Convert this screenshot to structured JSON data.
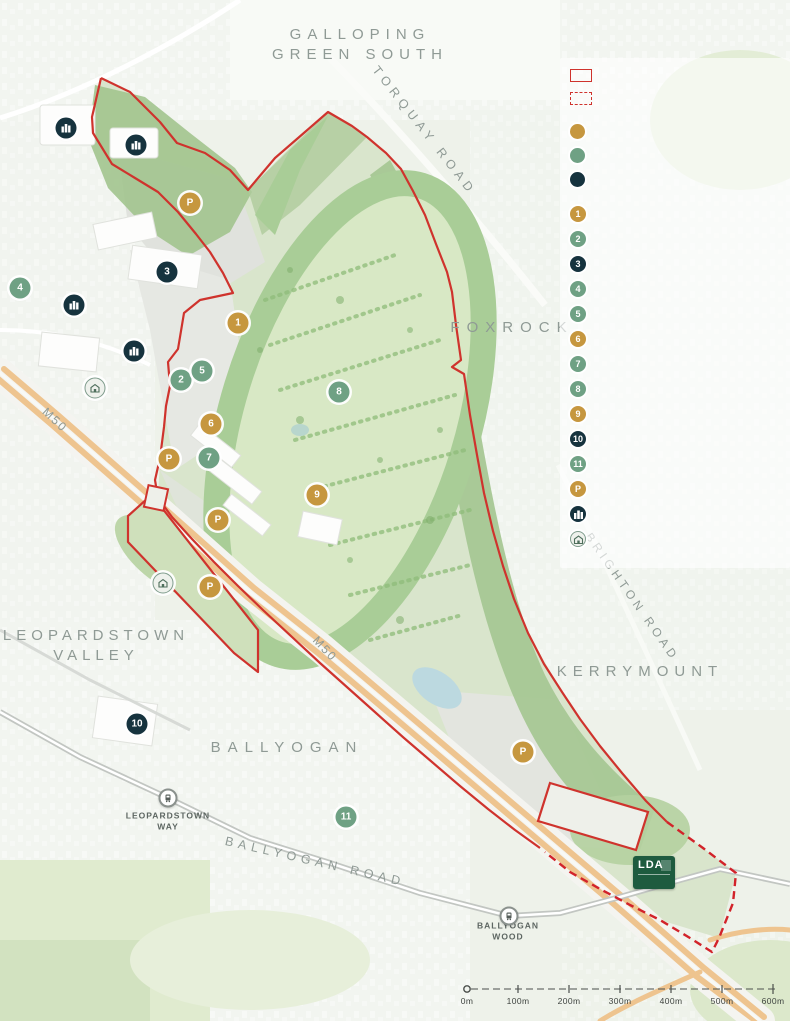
{
  "colors": {
    "boundary_red": "#cf332d",
    "race_gold": "#c6973f",
    "community_green": "#6fa184",
    "business_navy": "#16333e",
    "label_gray": "#8f9a95"
  },
  "legend": {
    "boundaries": [
      {
        "style": "solid",
        "label": "Leopardstown Campus Boundary - HRI"
      },
      {
        "style": "dashed",
        "label": "Leopardstown Campus Boundary - LDA"
      }
    ],
    "categories": [
      {
        "color": "#c6973f",
        "label": "Race Event Uses"
      },
      {
        "color": "#6fa184",
        "label": "Community, Education and Leisure"
      },
      {
        "color": "#16333e",
        "label": "Business & Commerce"
      }
    ],
    "items": [
      {
        "num": "1",
        "type": "race",
        "label": "Racecourse Track"
      },
      {
        "num": "2",
        "type": "community",
        "label": "Super Social"
      },
      {
        "num": "3",
        "type": "business",
        "label": "Microsoft Ireland"
      },
      {
        "num": "4",
        "type": "community",
        "label": "Leopardstown Hospital"
      },
      {
        "num": "5",
        "type": "community",
        "label": "Leopardstown Pavilion - Conferences and Entertainment"
      },
      {
        "num": "6",
        "type": "race",
        "label": "Racecourse Grandstand"
      },
      {
        "num": "7",
        "type": "community",
        "label": "West Wood Club"
      },
      {
        "num": "8",
        "type": "community",
        "label": "Leopardstown Driving Range & Golf Centre"
      },
      {
        "num": "9",
        "type": "race",
        "label": "Racecourse Stables"
      },
      {
        "num": "10",
        "type": "business",
        "label": "Leopardstown Village Centre"
      },
      {
        "num": "11",
        "type": "community",
        "label": "Ballyogan Community Centre"
      }
    ],
    "extras": [
      {
        "icon": "parking",
        "label": "Car Parking"
      },
      {
        "icon": "offices",
        "label": "Offices"
      },
      {
        "icon": "school",
        "label": "School"
      }
    ]
  },
  "map": {
    "area_labels": [
      {
        "text": "GALLOPING\nGREEN SOUTH",
        "x": 360,
        "y": 45,
        "size": 15,
        "spacing": 6,
        "rotate": 0
      },
      {
        "text": "TORQUAY ROAD",
        "x": 424,
        "y": 131,
        "size": 12.5,
        "spacing": 5,
        "rotate": 52
      },
      {
        "text": "FOXROCK",
        "x": 512,
        "y": 328,
        "size": 15,
        "spacing": 7,
        "rotate": 0
      },
      {
        "text": "BRIGHTON ROAD",
        "x": 632,
        "y": 597,
        "size": 12,
        "spacing": 4,
        "rotate": 55
      },
      {
        "text": "KERRYMOUNT",
        "x": 640,
        "y": 672,
        "size": 15,
        "spacing": 6,
        "rotate": 0
      },
      {
        "text": "LEOPARDSTOWN\nVALLEY",
        "x": 96,
        "y": 646,
        "size": 15,
        "spacing": 5,
        "rotate": 0
      },
      {
        "text": "BALLYOGAN",
        "x": 287,
        "y": 748,
        "size": 15,
        "spacing": 7,
        "rotate": 0
      },
      {
        "text": "M50",
        "x": 55,
        "y": 420,
        "size": 12,
        "spacing": 2,
        "rotate": 43
      },
      {
        "text": "M50",
        "x": 325,
        "y": 649,
        "size": 12,
        "spacing": 2,
        "rotate": 47
      },
      {
        "text": "BALLYOGAN ROAD",
        "x": 315,
        "y": 862,
        "size": 12.5,
        "spacing": 5,
        "rotate": 13
      },
      {
        "text": "LEOPARDSTOWN\nWAY",
        "x": 168,
        "y": 821,
        "size": 8.5,
        "spacing": 1,
        "rotate": 0,
        "small": true
      },
      {
        "text": "BALLYOGAN\nWOOD",
        "x": 508,
        "y": 931,
        "size": 8.5,
        "spacing": 1,
        "rotate": 0,
        "small": true
      }
    ],
    "numbered_markers": [
      {
        "num": "1",
        "type": "race",
        "x": 238,
        "y": 323
      },
      {
        "num": "2",
        "type": "community",
        "x": 181,
        "y": 380
      },
      {
        "num": "3",
        "type": "business",
        "x": 167,
        "y": 272
      },
      {
        "num": "4",
        "type": "community",
        "x": 20,
        "y": 288
      },
      {
        "num": "5",
        "type": "community",
        "x": 202,
        "y": 371
      },
      {
        "num": "6",
        "type": "race",
        "x": 211,
        "y": 424
      },
      {
        "num": "7",
        "type": "community",
        "x": 209,
        "y": 458
      },
      {
        "num": "8",
        "type": "community",
        "x": 339,
        "y": 392
      },
      {
        "num": "9",
        "type": "race",
        "x": 317,
        "y": 495
      },
      {
        "num": "10",
        "type": "business",
        "x": 137,
        "y": 724
      },
      {
        "num": "11",
        "type": "community",
        "x": 346,
        "y": 817
      }
    ],
    "parking_markers": [
      {
        "x": 190,
        "y": 203
      },
      {
        "x": 169,
        "y": 459
      },
      {
        "x": 218,
        "y": 520
      },
      {
        "x": 210,
        "y": 587
      },
      {
        "x": 523,
        "y": 752
      }
    ],
    "offices_markers": [
      {
        "x": 66,
        "y": 128
      },
      {
        "x": 136,
        "y": 145
      },
      {
        "x": 74,
        "y": 305
      },
      {
        "x": 134,
        "y": 351
      }
    ],
    "school_markers": [
      {
        "x": 95,
        "y": 388
      },
      {
        "x": 163,
        "y": 583
      }
    ],
    "tram_stops": [
      {
        "x": 168,
        "y": 798
      },
      {
        "x": 509,
        "y": 916
      }
    ],
    "lda_logo": {
      "text": "LDA"
    }
  },
  "scale_bar": {
    "labels": [
      "0m",
      "100m",
      "200m",
      "300m",
      "400m",
      "500m",
      "600m"
    ]
  }
}
